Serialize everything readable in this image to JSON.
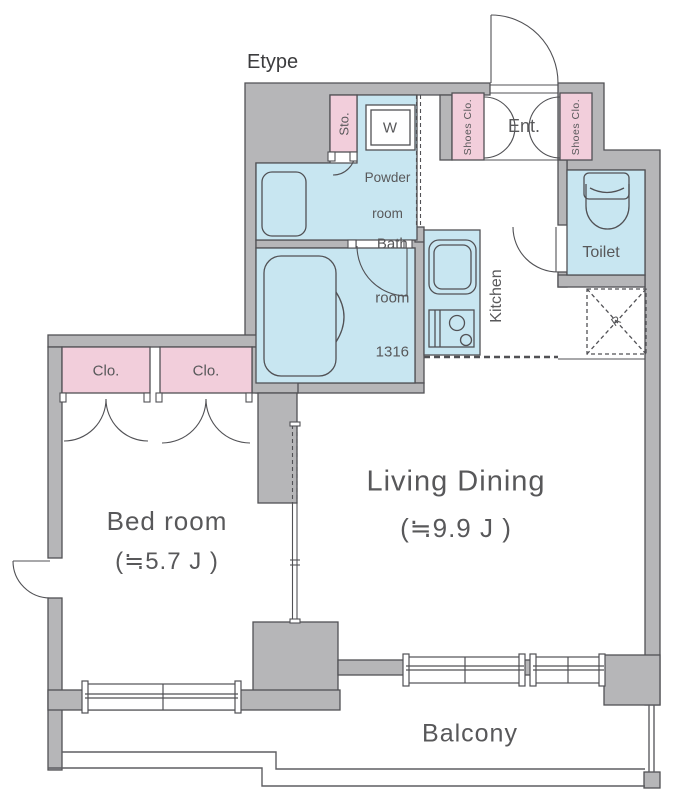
{
  "title": "Etype",
  "colors": {
    "wall": "#b6b6b8",
    "pink": "#f2cedb",
    "blue": "#c8e6f1",
    "line": "#515155",
    "text": "#58585a"
  },
  "rooms": {
    "storage": "Sto.",
    "washer": "W",
    "powder_line1": "Powder",
    "powder_line2": "room",
    "shoes_closet_left": "Shoes Clo.",
    "entrance": "Ent.",
    "shoes_closet_right": "Shoes Clo.",
    "toilet": "Toilet",
    "bath_line1": "Bath",
    "bath_line2": "room",
    "bath_line3": "1316",
    "kitchen": "Kitchen",
    "refrigerator": "R",
    "closet1": "Clo.",
    "closet2": "Clo.",
    "living_name": "Living Dining",
    "living_size": "(≒9.9 J )",
    "bed_name": "Bed room",
    "bed_size": "(≒5.7 J )",
    "balcony": "Balcony"
  }
}
